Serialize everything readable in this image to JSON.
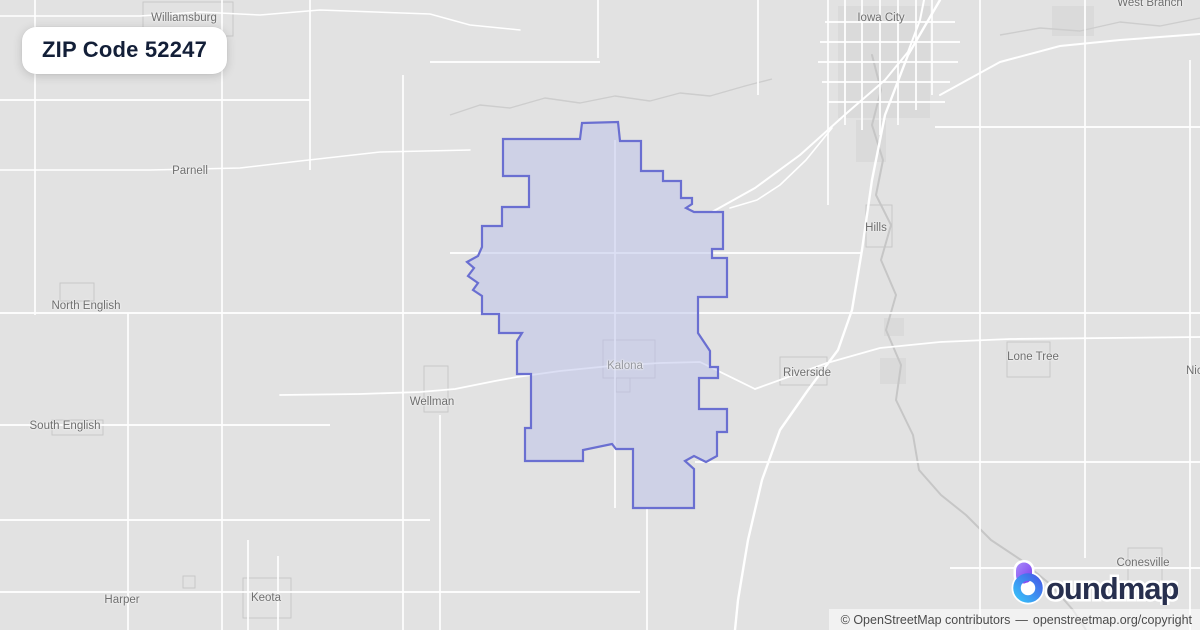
{
  "badge": {
    "label": "ZIP Code 52247"
  },
  "attribution": {
    "prefix": "© OpenStreetMap contributors",
    "separator": "—",
    "link": "openstreetmap.org/copyright"
  },
  "logo": {
    "full_name": "boundmaps",
    "wordmark_tail": "oundmaps",
    "text_color": "#272f4e",
    "icon_purple_light": "#a78bfa",
    "icon_purple_dark": "#7c3aed",
    "icon_blue_light": "#38bdf8",
    "icon_blue_dark": "#4460e8"
  },
  "map": {
    "background": "#e2e2e2",
    "road_color": "#ffffff",
    "stream_color": "#cdcdcd",
    "river_color": "#c6c6c6",
    "urban_color": "#d7d7d7",
    "town_outline_color": "#c8c8c8",
    "zip_boundary": {
      "zip": "52247",
      "stroke": "#6a6fd1",
      "stroke_width": 2.2,
      "fill": "#b9bfe9",
      "fill_opacity": 0.5,
      "points": [
        [
          582,
          123
        ],
        [
          618,
          122
        ],
        [
          620,
          141
        ],
        [
          641,
          141
        ],
        [
          641,
          171
        ],
        [
          663,
          171
        ],
        [
          663,
          181
        ],
        [
          681,
          181
        ],
        [
          681,
          198
        ],
        [
          692,
          198
        ],
        [
          692,
          204
        ],
        [
          686,
          208
        ],
        [
          694,
          212
        ],
        [
          723,
          212
        ],
        [
          723,
          249
        ],
        [
          712,
          249
        ],
        [
          712,
          258
        ],
        [
          727,
          258
        ],
        [
          727,
          297
        ],
        [
          698,
          297
        ],
        [
          698,
          333
        ],
        [
          710,
          351
        ],
        [
          710,
          367
        ],
        [
          718,
          367
        ],
        [
          718,
          378
        ],
        [
          699,
          378
        ],
        [
          699,
          409
        ],
        [
          727,
          409
        ],
        [
          727,
          432
        ],
        [
          717,
          432
        ],
        [
          717,
          456
        ],
        [
          706,
          462
        ],
        [
          694,
          456
        ],
        [
          685,
          461
        ],
        [
          694,
          469
        ],
        [
          694,
          508
        ],
        [
          633,
          508
        ],
        [
          633,
          449
        ],
        [
          616,
          449
        ],
        [
          612,
          444
        ],
        [
          583,
          450
        ],
        [
          583,
          461
        ],
        [
          525,
          461
        ],
        [
          525,
          428
        ],
        [
          531,
          428
        ],
        [
          531,
          374
        ],
        [
          517,
          374
        ],
        [
          517,
          341
        ],
        [
          522,
          333
        ],
        [
          499,
          333
        ],
        [
          499,
          314
        ],
        [
          482,
          314
        ],
        [
          482,
          296
        ],
        [
          473,
          290
        ],
        [
          478,
          283
        ],
        [
          468,
          276
        ],
        [
          474,
          268
        ],
        [
          467,
          262
        ],
        [
          478,
          256
        ],
        [
          482,
          247
        ],
        [
          482,
          226
        ],
        [
          502,
          226
        ],
        [
          502,
          207
        ],
        [
          529,
          207
        ],
        [
          529,
          176
        ],
        [
          503,
          176
        ],
        [
          503,
          139
        ],
        [
          580,
          139
        ]
      ]
    },
    "towns": [
      {
        "name": "Williamsburg",
        "x": 184,
        "y": 18
      },
      {
        "name": "Iowa City",
        "x": 881,
        "y": 18
      },
      {
        "name": "West Branch",
        "x": 1150,
        "y": 3
      },
      {
        "name": "Parnell",
        "x": 190,
        "y": 171
      },
      {
        "name": "Hills",
        "x": 876,
        "y": 228
      },
      {
        "name": "North English",
        "x": 86,
        "y": 306
      },
      {
        "name": "Lone Tree",
        "x": 1033,
        "y": 357
      },
      {
        "name": "Kalona",
        "x": 625,
        "y": 366,
        "muted": true
      },
      {
        "name": "Riverside",
        "x": 807,
        "y": 373
      },
      {
        "name": "Wellman",
        "x": 432,
        "y": 402
      },
      {
        "name": "South English",
        "x": 65,
        "y": 426
      },
      {
        "name": "Conesville",
        "x": 1143,
        "y": 563
      },
      {
        "name": "Harper",
        "x": 122,
        "y": 600
      },
      {
        "name": "Keota",
        "x": 266,
        "y": 598
      },
      {
        "name": "Nichols",
        "x": 1186,
        "y": 371,
        "anchor": "left"
      }
    ],
    "urban_patches": [
      [
        838,
        6,
        92,
        112
      ],
      [
        856,
        120,
        30,
        42
      ],
      [
        884,
        318,
        20,
        18
      ],
      [
        1052,
        6,
        42,
        30
      ],
      [
        880,
        358,
        26,
        26
      ]
    ],
    "town_outlines": [
      [
        143,
        2,
        90,
        34
      ],
      [
        603,
        340,
        52,
        38
      ],
      [
        616,
        378,
        14,
        14
      ],
      [
        424,
        366,
        24,
        46
      ],
      [
        243,
        578,
        48,
        40
      ],
      [
        60,
        283,
        34,
        18
      ],
      [
        866,
        205,
        26,
        42
      ],
      [
        780,
        357,
        47,
        28
      ],
      [
        1007,
        342,
        43,
        35
      ],
      [
        1128,
        548,
        34,
        42
      ],
      [
        183,
        576,
        12,
        12
      ],
      [
        52,
        420,
        51,
        15
      ]
    ],
    "roads": {
      "vertical": [
        [
          222,
          0,
          630
        ],
        [
          310,
          0,
          170
        ],
        [
          403,
          75,
          630
        ],
        [
          35,
          0,
          315
        ],
        [
          128,
          313,
          630
        ],
        [
          248,
          540,
          630
        ],
        [
          278,
          556,
          630
        ],
        [
          440,
          415,
          630
        ],
        [
          615,
          140,
          508
        ],
        [
          647,
          508,
          630
        ],
        [
          828,
          0,
          205
        ],
        [
          980,
          0,
          630
        ],
        [
          1085,
          0,
          558
        ],
        [
          1190,
          60,
          630
        ],
        [
          758,
          0,
          95
        ],
        [
          598,
          0,
          58
        ],
        [
          845,
          0,
          125
        ],
        [
          862,
          0,
          130
        ],
        [
          880,
          0,
          135
        ],
        [
          898,
          0,
          125
        ],
        [
          916,
          0,
          110
        ],
        [
          932,
          0,
          95
        ]
      ],
      "horizontal": [
        [
          100,
          0,
          310
        ],
        [
          313,
          0,
          1200
        ],
        [
          425,
          0,
          330
        ],
        [
          520,
          0,
          430
        ],
        [
          592,
          0,
          640
        ],
        [
          62,
          430,
          600
        ],
        [
          253,
          450,
          862
        ],
        [
          462,
          695,
          1200
        ],
        [
          568,
          950,
          1200
        ],
        [
          127,
          935,
          1200
        ],
        [
          22,
          825,
          955
        ],
        [
          42,
          820,
          960
        ],
        [
          62,
          818,
          958
        ],
        [
          82,
          822,
          950
        ],
        [
          102,
          828,
          945
        ]
      ],
      "paths": [
        {
          "w": 1.5,
          "pts": [
            [
              0,
              16
            ],
            [
              140,
              16
            ],
            [
              200,
              12
            ],
            [
              260,
              15
            ],
            [
              320,
              10
            ],
            [
              430,
              14
            ],
            [
              470,
              25
            ],
            [
              520,
              30
            ]
          ]
        },
        {
          "w": 1.5,
          "pts": [
            [
              0,
              170
            ],
            [
              150,
              170
            ],
            [
              240,
              168
            ],
            [
              300,
              161
            ],
            [
              380,
              152
            ],
            [
              470,
              150
            ]
          ]
        },
        {
          "w": 1.8,
          "pts": [
            [
              280,
              395
            ],
            [
              360,
              394
            ],
            [
              420,
              392
            ],
            [
              455,
              389
            ],
            [
              495,
              381
            ],
            [
              517,
              377
            ],
            [
              560,
              371
            ],
            [
              610,
              366
            ],
            [
              660,
              363
            ],
            [
              700,
              362
            ],
            [
              755,
              389
            ]
          ]
        },
        {
          "w": 1.8,
          "pts": [
            [
              755,
              389
            ],
            [
              827,
              363
            ],
            [
              880,
              348
            ],
            [
              940,
              342
            ],
            [
              1010,
              339
            ],
            [
              1200,
              337
            ]
          ]
        },
        {
          "w": 2.4,
          "pts": [
            [
              940,
              0
            ],
            [
              908,
              55
            ],
            [
              885,
              115
            ],
            [
              872,
              180
            ],
            [
              862,
              250
            ],
            [
              852,
              310
            ],
            [
              838,
              350
            ],
            [
              808,
              390
            ],
            [
              780,
              430
            ],
            [
              762,
              480
            ],
            [
              748,
              540
            ],
            [
              738,
              600
            ],
            [
              735,
              630
            ]
          ]
        },
        {
          "w": 2,
          "pts": [
            [
              712,
              212
            ],
            [
              755,
              188
            ],
            [
              800,
              155
            ],
            [
              848,
              112
            ],
            [
              885,
              80
            ],
            [
              908,
              52
            ],
            [
              920,
              20
            ],
            [
              924,
              0
            ]
          ]
        },
        {
          "w": 2,
          "pts": [
            [
              940,
              95
            ],
            [
              1000,
              62
            ],
            [
              1060,
              46
            ],
            [
              1120,
              40
            ],
            [
              1200,
              34
            ]
          ]
        },
        {
          "w": 1.6,
          "pts": [
            [
              832,
              128
            ],
            [
              806,
              160
            ],
            [
              780,
              185
            ],
            [
              757,
              200
            ],
            [
              730,
              208
            ]
          ]
        }
      ]
    },
    "streams": [
      {
        "pts": [
          [
            450,
            115
          ],
          [
            480,
            105
          ],
          [
            510,
            108
          ],
          [
            545,
            98
          ],
          [
            580,
            103
          ],
          [
            615,
            96
          ],
          [
            650,
            101
          ],
          [
            680,
            93
          ],
          [
            710,
            96
          ],
          [
            745,
            86
          ],
          [
            772,
            79
          ]
        ]
      },
      {
        "pts": [
          [
            1000,
            35
          ],
          [
            1040,
            28
          ],
          [
            1080,
            31
          ],
          [
            1120,
            22
          ],
          [
            1160,
            26
          ],
          [
            1200,
            18
          ]
        ]
      }
    ],
    "river": {
      "name": "Iowa River",
      "pts": [
        [
          872,
          55
        ],
        [
          881,
          90
        ],
        [
          872,
          125
        ],
        [
          883,
          160
        ],
        [
          876,
          195
        ],
        [
          891,
          225
        ],
        [
          881,
          260
        ],
        [
          896,
          295
        ],
        [
          886,
          330
        ],
        [
          901,
          365
        ],
        [
          896,
          400
        ],
        [
          913,
          435
        ],
        [
          919,
          470
        ],
        [
          941,
          495
        ],
        [
          966,
          515
        ],
        [
          991,
          540
        ],
        [
          1021,
          560
        ],
        [
          1051,
          585
        ],
        [
          1073,
          610
        ],
        [
          1086,
          630
        ]
      ]
    }
  }
}
